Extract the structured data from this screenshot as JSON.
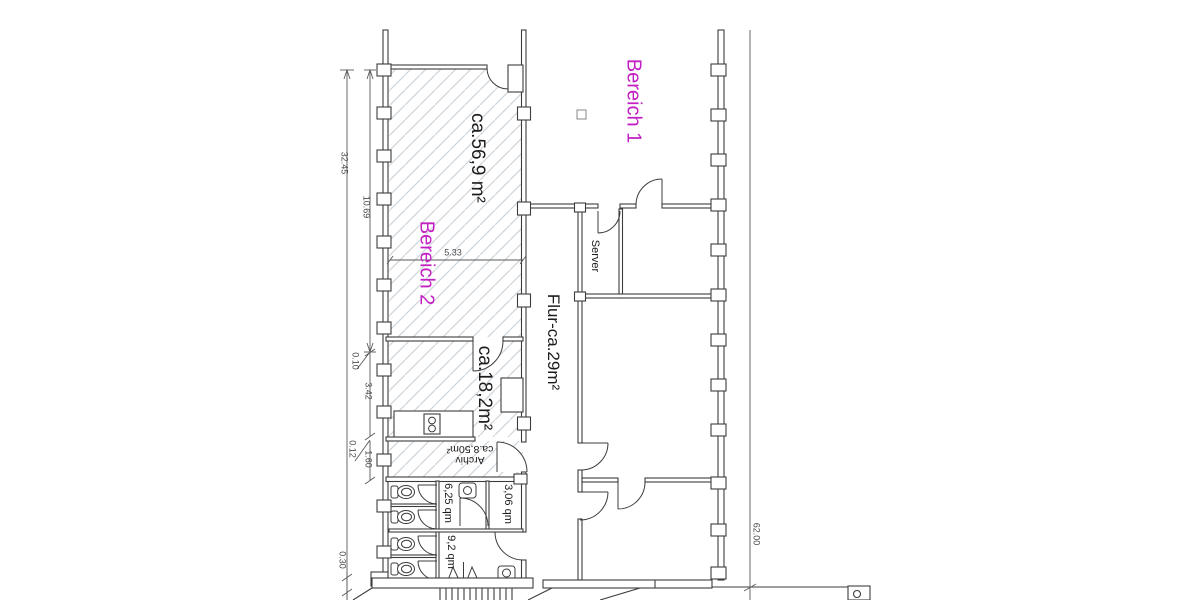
{
  "plan": {
    "region_labels": {
      "bereich1": "Bereich 1",
      "bereich2": "Bereich 2"
    },
    "room_labels": {
      "area56": "ca.56,9 m²",
      "area18": "ca.18,2m²",
      "flur": "Flur-ca.29m²",
      "server": "Server",
      "archiv_line1": "Archiv",
      "archiv_line2": "ca.8,50m²",
      "wc625": "6,25 qm",
      "wc306": "3,06 qm",
      "wc92": "9,2 qm"
    },
    "dimension_labels": {
      "total_left": "32.45",
      "upper_left": "10.69",
      "room_width": "5.33",
      "gap_upper": "0.10",
      "mid_left": "3.42",
      "gap_lower": "0.12",
      "lower_left": "1.60",
      "bottom_left": "0.30",
      "total_right": "62.00"
    },
    "colors": {
      "area_label": "#c320c3",
      "linework": "#3c3c3c",
      "hatch": "#cdd4d9",
      "dimension": "#4a4a4a"
    }
  }
}
